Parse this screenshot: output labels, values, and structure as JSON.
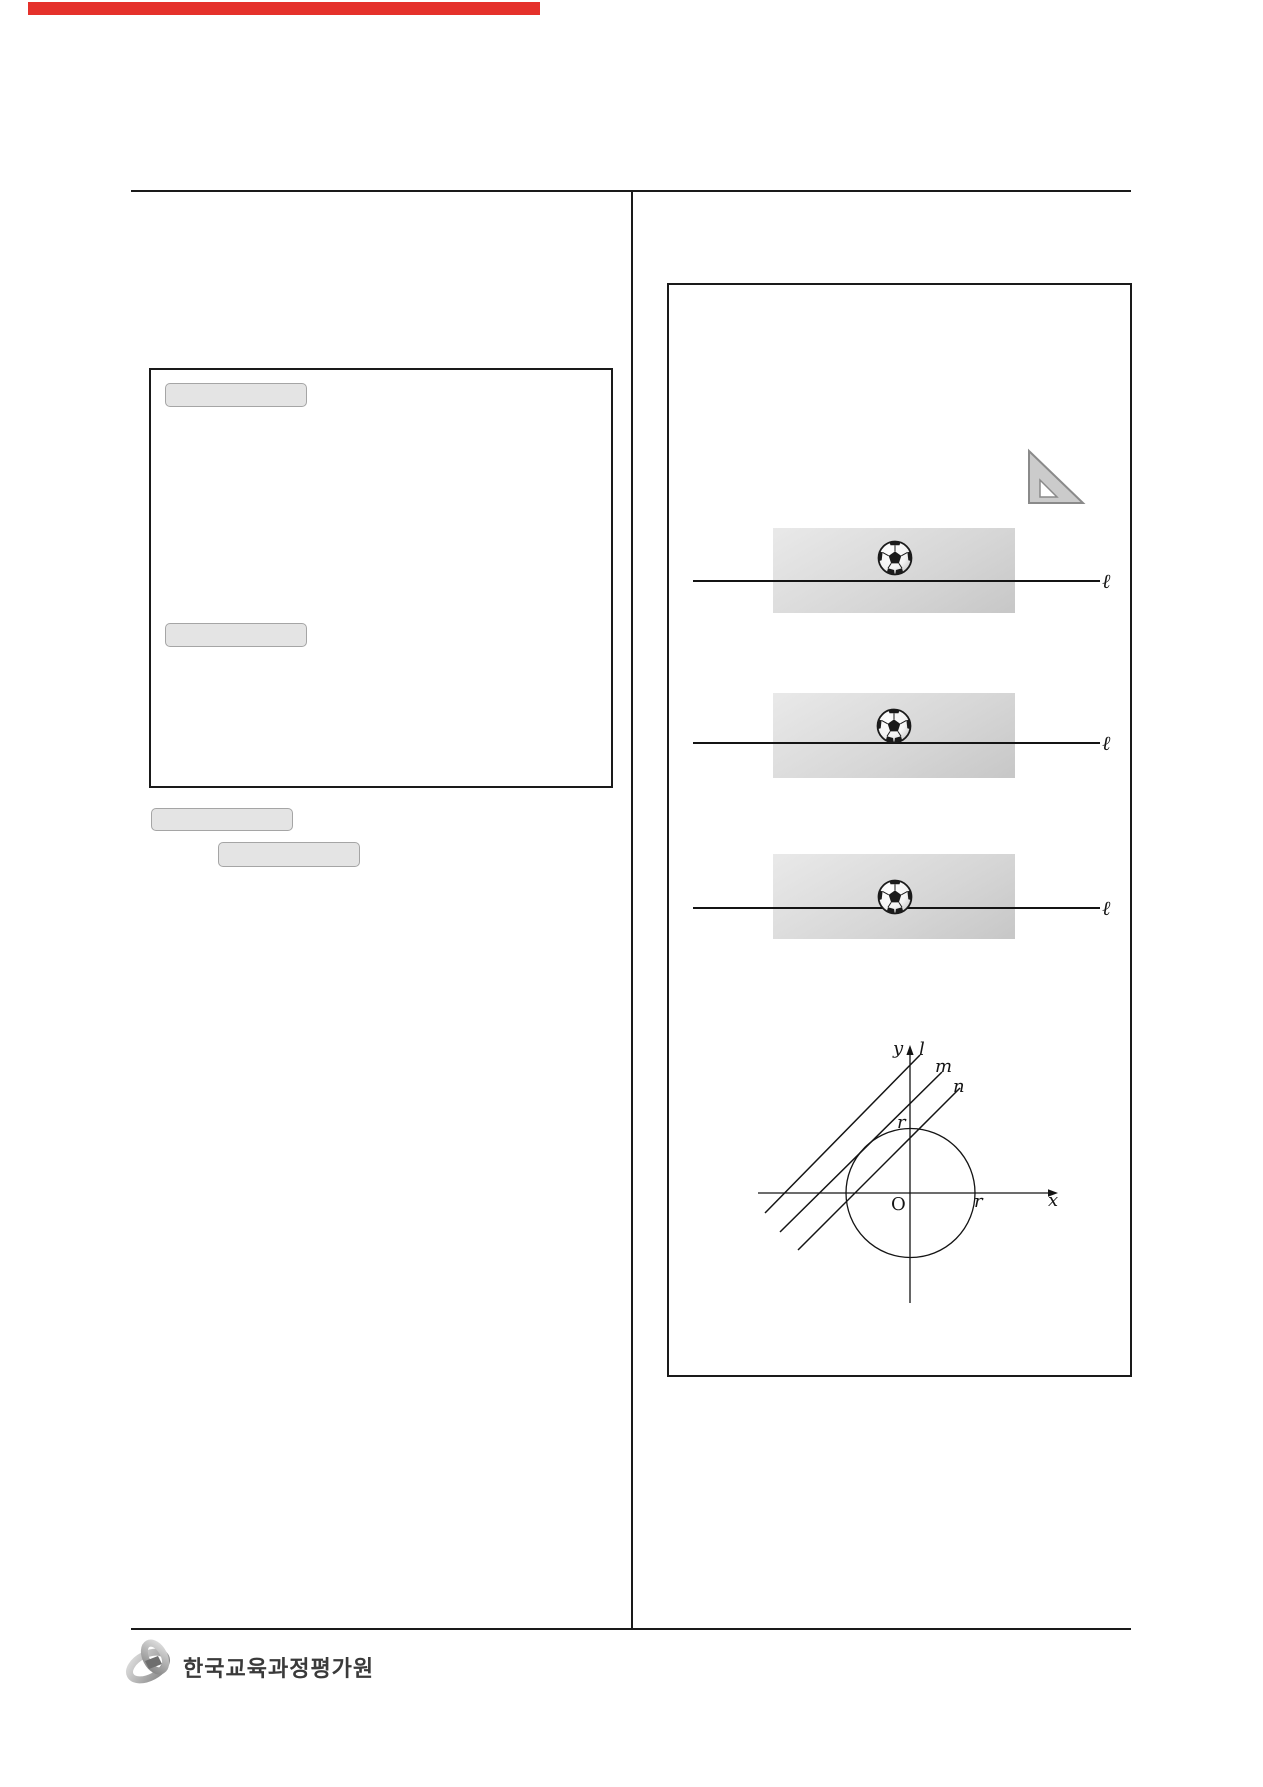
{
  "header": {
    "top_bar_color": "#e5312b"
  },
  "right_panel": {
    "figures": [
      {
        "line_label": "ℓ"
      },
      {
        "line_label": "ℓ"
      },
      {
        "line_label": "ℓ"
      }
    ],
    "coord": {
      "y": "y",
      "l": "l",
      "m": "m",
      "n": "n",
      "r_top": "r",
      "origin": "O",
      "r_right": "r",
      "x": "x"
    }
  },
  "footer": {
    "institute_name": "한국교육과정평가원"
  }
}
